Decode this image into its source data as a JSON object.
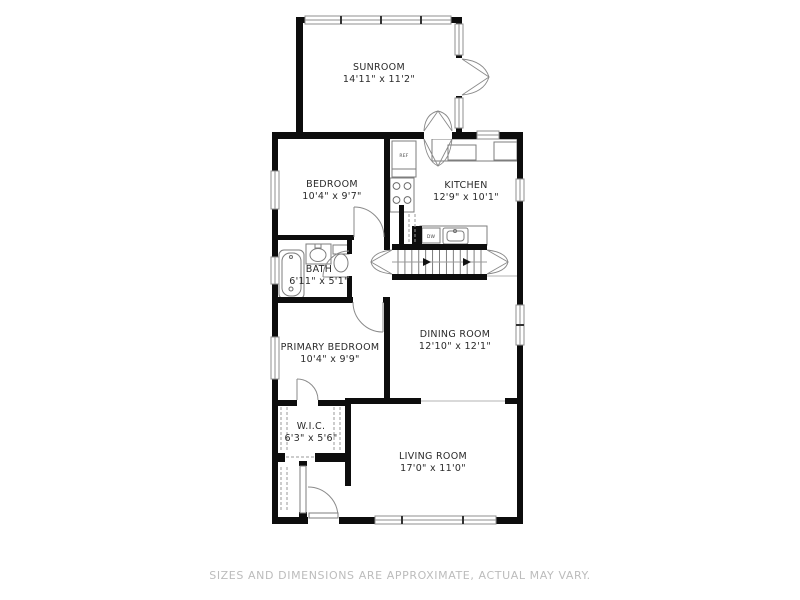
{
  "disclaimer": "SIZES AND DIMENSIONS ARE APPROXIMATE, ACTUAL MAY VARY.",
  "colors": {
    "wall": "#0d0d0d",
    "fixture": "#7d7d7d",
    "window_frame": "#8f8f8f",
    "mullion": "#333333",
    "door": "#8a8a8a",
    "tread": "#6f6f6f",
    "dash": "#9a9a9a",
    "faint": "#d9d9d9",
    "label": "#2a2a2a",
    "arrow": "#111111",
    "background": "#ffffff"
  },
  "rooms": [
    {
      "id": "sunroom",
      "name": "SUNROOM",
      "dims": "14'11\" x 11'2\"",
      "cx": 379,
      "name_y": 70,
      "dims_y": 82
    },
    {
      "id": "bedroom",
      "name": "BEDROOM",
      "dims": "10'4\" x 9'7\"",
      "cx": 332,
      "name_y": 187,
      "dims_y": 199
    },
    {
      "id": "kitchen",
      "name": "KITCHEN",
      "dims": "12'9\" x 10'1\"",
      "cx": 466,
      "name_y": 188,
      "dims_y": 200
    },
    {
      "id": "bath",
      "name": "BATH",
      "dims": "6'11\" x 5'1\"",
      "cx": 319,
      "name_y": 272,
      "dims_y": 284
    },
    {
      "id": "dining-room",
      "name": "DINING ROOM",
      "dims": "12'10\" x 12'1\"",
      "cx": 455,
      "name_y": 337,
      "dims_y": 349
    },
    {
      "id": "primary-bedroom",
      "name": "PRIMARY BEDROOM",
      "dims": "10'4\" x 9'9\"",
      "cx": 330,
      "name_y": 350,
      "dims_y": 362
    },
    {
      "id": "wic",
      "name": "W.I.C.",
      "dims": "6'3\" x 5'6\"",
      "cx": 311,
      "name_y": 429,
      "dims_y": 441
    },
    {
      "id": "living-room",
      "name": "LIVING ROOM",
      "dims": "17'0\" x 11'0\"",
      "cx": 433,
      "name_y": 459,
      "dims_y": 471
    }
  ],
  "appliance_labels": [
    {
      "id": "refrigerator",
      "text": "REF",
      "x": 404,
      "y": 157
    },
    {
      "id": "dishwasher",
      "text": "DW",
      "x": 431,
      "y": 238
    }
  ],
  "geometry": {
    "walls": [
      [
        296,
        17,
        166,
        6
      ],
      [
        296,
        17,
        7,
        121
      ],
      [
        456,
        17,
        6,
        121
      ],
      [
        272,
        132,
        251,
        7
      ],
      [
        272,
        132,
        6,
        392
      ],
      [
        517,
        132,
        6,
        392
      ],
      [
        272,
        517,
        251,
        7
      ],
      [
        384,
        139,
        6,
        111
      ],
      [
        278,
        235,
        76,
        5
      ],
      [
        347,
        240,
        5,
        14
      ],
      [
        347,
        276,
        5,
        27
      ],
      [
        272,
        297,
        81,
        6
      ],
      [
        383,
        297,
        7,
        6
      ],
      [
        384,
        297,
        6,
        106
      ],
      [
        392,
        244,
        95,
        6
      ],
      [
        392,
        274,
        95,
        6
      ],
      [
        345,
        398,
        76,
        6
      ],
      [
        505,
        398,
        18,
        6
      ],
      [
        272,
        400,
        25,
        6
      ],
      [
        318,
        400,
        27,
        6
      ],
      [
        345,
        398,
        6,
        66
      ],
      [
        272,
        453,
        13,
        9
      ],
      [
        315,
        453,
        30,
        9
      ],
      [
        345,
        462,
        6,
        24
      ],
      [
        399,
        205,
        5,
        40
      ],
      [
        412,
        226,
        10,
        18
      ],
      [
        299,
        461,
        8,
        5
      ],
      [
        299,
        512,
        8,
        5
      ]
    ],
    "openings": [
      [
        455,
        58,
        8,
        38
      ],
      [
        424,
        132,
        28,
        7
      ],
      [
        308,
        516,
        31,
        9
      ]
    ],
    "windows": [
      {
        "r": [
          305,
          16,
          146,
          8
        ],
        "dir": "h",
        "m": [
          341,
          381,
          421
        ]
      },
      {
        "r": [
          477,
          131,
          22,
          8
        ],
        "dir": "h",
        "m": []
      },
      {
        "r": [
          375,
          516,
          121,
          8
        ],
        "dir": "h",
        "m": [
          402,
          463
        ]
      },
      {
        "r": [
          455,
          24,
          8,
          31
        ],
        "dir": "v",
        "m": []
      },
      {
        "r": [
          455,
          98,
          8,
          30
        ],
        "dir": "v",
        "m": []
      },
      {
        "r": [
          271,
          171,
          8,
          38
        ],
        "dir": "v",
        "m": []
      },
      {
        "r": [
          271,
          257,
          8,
          27
        ],
        "dir": "v",
        "m": []
      },
      {
        "r": [
          271,
          337,
          8,
          42
        ],
        "dir": "v",
        "m": []
      },
      {
        "r": [
          516,
          179,
          8,
          22
        ],
        "dir": "v",
        "m": []
      },
      {
        "r": [
          516,
          305,
          8,
          40
        ],
        "dir": "v",
        "m": [
          325
        ]
      }
    ],
    "door_arcs": [
      {
        "arc": "M384 237 A30 30 0 0 0 354 207",
        "leaf": [
          354,
          237,
          354,
          207
        ]
      },
      {
        "arc": "M349 251 A26 26 0 0 0 323 277",
        "leaf": [
          349,
          277,
          323,
          277
        ]
      },
      {
        "arc": "M353 302 A30 30 0 0 0 383 332",
        "leaf": [
          383,
          302,
          383,
          332
        ]
      },
      {
        "arc": "M318 400 A21 21 0 0 0 297 379",
        "leaf": [
          297,
          400,
          297,
          379
        ]
      },
      {
        "arc": "M338 517 A30 30 0 0 0 308 487",
        "leaf": null
      }
    ],
    "arch_paths": [
      "M392 250 L371 262 L392 274 M392 250 Q373 252 371 262 Q373 272 392 274",
      "M487 250 L508 262 L487 274 M487 250 Q506 252 508 262 Q506 272 487 274",
      "M462 59 L489 77 L462 95 M462 59 Q484 61 489 77 Q484 93 462 95",
      "M424 139 L438 166 L452 139 M424 139 Q426 160 438 166 Q450 160 452 139",
      "M424 131 L438 111 L452 131 M424 131 Q425 114 438 111 Q451 114 452 131"
    ],
    "stairs": {
      "x1": 392,
      "x2": 487,
      "y1": 250,
      "y2": 274,
      "treads": 13,
      "mid": 262,
      "arrows": [
        423,
        463
      ]
    },
    "fixtures": {
      "rects": [
        [
          392,
          141,
          24,
          28
        ],
        [
          392,
          169,
          24,
          8
        ],
        [
          390,
          178,
          24,
          34
        ],
        [
          432,
          139,
          85,
          22
        ],
        [
          448,
          145,
          28,
          15
        ],
        [
          494,
          142,
          23,
          18
        ],
        [
          420,
          226,
          67,
          19
        ],
        [
          422,
          228,
          18,
          15
        ],
        [
          306,
          244,
          25,
          20
        ],
        [
          333,
          245,
          16,
          9
        ],
        [
          315,
          244,
          6,
          4
        ]
      ],
      "rounded": [
        {
          "r": [
            279,
            250,
            25,
            49
          ],
          "rx": 5
        },
        {
          "r": [
            282,
            253,
            19,
            43
          ],
          "rx": 8
        },
        {
          "r": [
            443,
            228,
            25,
            16
          ],
          "rx": 2
        },
        {
          "r": [
            447,
            231,
            17,
            10
          ],
          "rx": 3
        }
      ],
      "circles": [
        [
          396.5,
          186,
          3.4
        ],
        [
          407.5,
          186,
          3.4
        ],
        [
          396.5,
          200,
          3.4
        ],
        [
          407.5,
          200,
          3.4
        ],
        [
          291,
          257,
          1.5
        ],
        [
          291,
          289,
          2
        ],
        [
          455,
          231,
          1.5
        ]
      ],
      "ellipses": [
        [
          318,
          255,
          8,
          6.5
        ],
        [
          341,
          263,
          7,
          9
        ]
      ]
    },
    "leaf_rects": [
      [
        300,
        466,
        6,
        47
      ],
      [
        309,
        513,
        29,
        5
      ]
    ],
    "dashes": [
      [
        281,
        407,
        281,
        452
      ],
      [
        287,
        407,
        287,
        452
      ],
      [
        334,
        407,
        334,
        452
      ],
      [
        340,
        407,
        340,
        452
      ],
      [
        286,
        457,
        314,
        457
      ],
      [
        281,
        467,
        281,
        512
      ],
      [
        287,
        467,
        287,
        512
      ],
      [
        409,
        214,
        409,
        242
      ],
      [
        415,
        214,
        415,
        242
      ]
    ],
    "faint": [
      [
        421,
        401,
        505,
        401
      ],
      [
        487,
        276,
        517,
        276
      ]
    ]
  }
}
